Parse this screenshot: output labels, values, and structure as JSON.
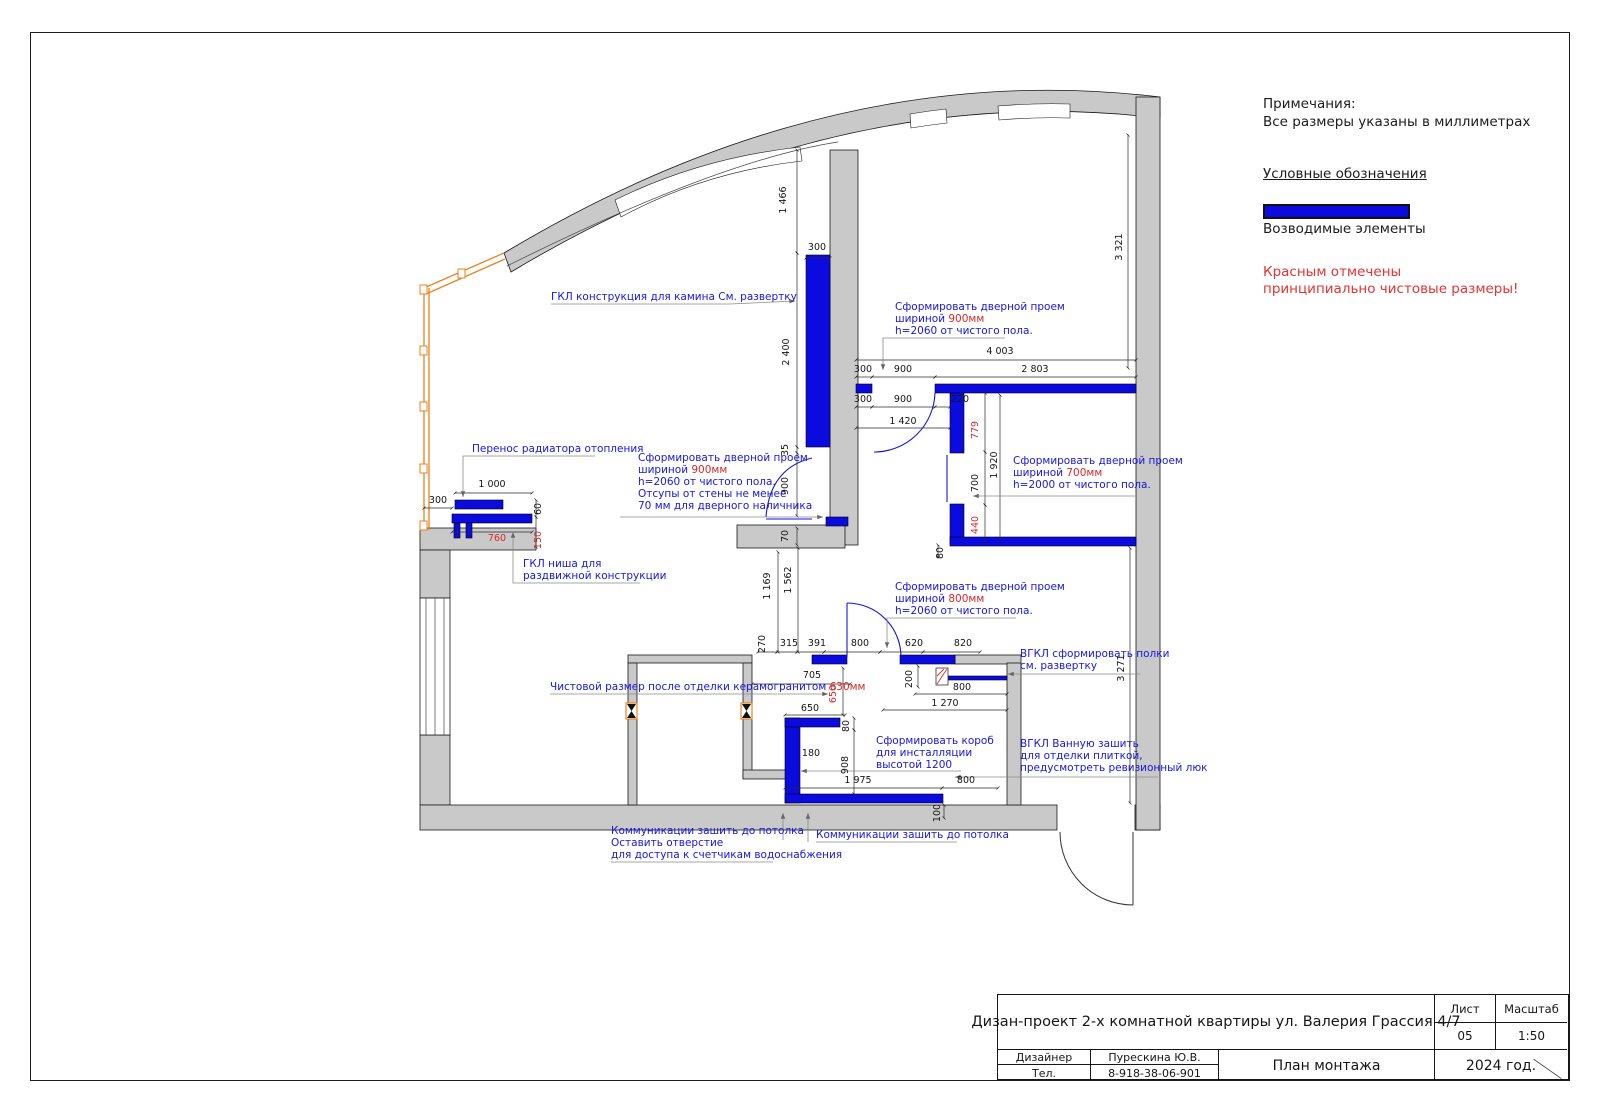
{
  "notes": {
    "title": "Примечания:",
    "subtitle": "Все размеры указаны в миллиметрах",
    "legend_title": "Условные обозначения",
    "legend_item": "Возводимые элементы",
    "red_note_line1": "Красным отмечены",
    "red_note_line2": "принципиально чистовые размеры!",
    "accent_blue": "#0b0bdf",
    "accent_red": "#d42a2a",
    "wall_gray": "#c9c9c9",
    "glazing_orange": "#e8821e"
  },
  "title_block": {
    "project": "Дизан-проект 2-х комнатной квартиры ул. Валерия Грассия 4/7",
    "sheet_label": "Лист",
    "sheet_value": "05",
    "scale_label": "Масштаб",
    "scale_value": "1:50",
    "designer_label": "Дизайнер",
    "designer_value": "Пурескина Ю.В.",
    "phone_label": "Тел.",
    "phone_value": "8-918-38-06-901",
    "drawing_title": "План монтажа",
    "year": "2024 год."
  },
  "plan": {
    "annotations": [
      {
        "x": 551,
        "y": 300,
        "lines": [
          [
            {
              "t": "ГКЛ конструкция для камина См. развертку"
            }
          ]
        ]
      },
      {
        "x": 472,
        "y": 452,
        "lines": [
          [
            {
              "t": "Перенос радиатора отопления"
            }
          ]
        ]
      },
      {
        "x": 638,
        "y": 461,
        "lines": [
          [
            {
              "t": "Сформировать дверной проем"
            }
          ],
          [
            {
              "t": "шириной "
            },
            {
              "t": "900мм",
              "c": "r"
            }
          ],
          [
            {
              "t": "h=2060 от чистого пола."
            }
          ],
          [
            {
              "t": "Отсупы от стены не менее"
            }
          ],
          [
            {
              "t": "70 мм для дверного наличника"
            }
          ]
        ]
      },
      {
        "x": 523,
        "y": 567,
        "lines": [
          [
            {
              "t": "ГКЛ ниша для"
            }
          ],
          [
            {
              "t": "раздвижной конструкции"
            }
          ]
        ]
      },
      {
        "x": 895,
        "y": 310,
        "lines": [
          [
            {
              "t": "Сформировать дверной проем"
            }
          ],
          [
            {
              "t": "шириной "
            },
            {
              "t": "900мм",
              "c": "r"
            }
          ],
          [
            {
              "t": "h=2060 от чистого пола."
            }
          ]
        ]
      },
      {
        "x": 1013,
        "y": 464,
        "lines": [
          [
            {
              "t": "Сформировать дверной проем"
            }
          ],
          [
            {
              "t": "шириной "
            },
            {
              "t": "700мм",
              "c": "r"
            }
          ],
          [
            {
              "t": "h=2000 от чистого пола."
            }
          ]
        ]
      },
      {
        "x": 895,
        "y": 590,
        "lines": [
          [
            {
              "t": "Сформировать дверной проем"
            }
          ],
          [
            {
              "t": "шириной "
            },
            {
              "t": "800мм",
              "c": "r"
            }
          ],
          [
            {
              "t": "h=2060 от чистого пола."
            }
          ]
        ]
      },
      {
        "x": 1020,
        "y": 657,
        "lines": [
          [
            {
              "t": "ВГКЛ сформировать полки"
            }
          ],
          [
            {
              "t": "см. развертку"
            }
          ]
        ]
      },
      {
        "x": 1020,
        "y": 747,
        "lines": [
          [
            {
              "t": "ВГКЛ Ванную зашить"
            }
          ],
          [
            {
              "t": "для отделки плиткой,"
            }
          ],
          [
            {
              "t": "предусмотреть ревизионный люк"
            }
          ]
        ]
      },
      {
        "x": 550,
        "y": 690,
        "lines": [
          [
            {
              "t": "Чистовой размер после отделки керамогранитом "
            },
            {
              "t": "630мм",
              "c": "r"
            }
          ]
        ]
      },
      {
        "x": 876,
        "y": 744,
        "lines": [
          [
            {
              "t": "Сформировать короб"
            }
          ],
          [
            {
              "t": "для инсталляции"
            }
          ],
          [
            {
              "t": "высотой 1200"
            }
          ]
        ]
      },
      {
        "x": 611,
        "y": 834,
        "lines": [
          [
            {
              "t": "Коммуникации зашить до потолка"
            }
          ],
          [
            {
              "t": "Оставить отверстие"
            }
          ],
          [
            {
              "t": "для доступа к счетчикам водоснабжения"
            }
          ]
        ]
      },
      {
        "x": 816,
        "y": 838,
        "lines": [
          [
            {
              "t": "Коммуникации зашить до потолка"
            }
          ]
        ]
      }
    ],
    "dim_labels": [
      {
        "t": "1 466",
        "x": 786,
        "y": 200,
        "r": 1
      },
      {
        "t": "300",
        "x": 817,
        "y": 250
      },
      {
        "t": "2 400",
        "x": 789,
        "y": 352,
        "r": 1
      },
      {
        "t": "35",
        "x": 788,
        "y": 450,
        "r": 1
      },
      {
        "t": "900",
        "x": 788,
        "y": 486,
        "r": 1
      },
      {
        "t": "70",
        "x": 788,
        "y": 536,
        "r": 1
      },
      {
        "t": "4 003",
        "x": 1000,
        "y": 354
      },
      {
        "t": "300",
        "x": 863,
        "y": 372
      },
      {
        "t": "900",
        "x": 903,
        "y": 372
      },
      {
        "t": "2 803",
        "x": 1035,
        "y": 372
      },
      {
        "t": "300",
        "x": 863,
        "y": 402
      },
      {
        "t": "900",
        "x": 903,
        "y": 402
      },
      {
        "t": "220",
        "x": 960,
        "y": 402
      },
      {
        "t": "1 420",
        "x": 903,
        "y": 424
      },
      {
        "t": "3 321",
        "x": 1122,
        "y": 247,
        "r": 1
      },
      {
        "t": "779",
        "x": 978,
        "y": 430,
        "r": 1,
        "c": "r"
      },
      {
        "t": "700",
        "x": 978,
        "y": 483,
        "r": 1
      },
      {
        "t": "1 920",
        "x": 997,
        "y": 465,
        "r": 1
      },
      {
        "t": "440",
        "x": 978,
        "y": 525,
        "r": 1,
        "c": "r"
      },
      {
        "t": "80",
        "x": 943,
        "y": 553,
        "r": 1
      },
      {
        "t": "3 271",
        "x": 1124,
        "y": 668,
        "r": 1
      },
      {
        "t": "1 000",
        "x": 492,
        "y": 487
      },
      {
        "t": "300",
        "x": 438,
        "y": 503
      },
      {
        "t": "60",
        "x": 541,
        "y": 509,
        "r": 1
      },
      {
        "t": "760",
        "x": 497,
        "y": 541,
        "c": "r"
      },
      {
        "t": "150",
        "x": 541,
        "y": 540,
        "r": 1,
        "c": "r"
      },
      {
        "t": "1 169",
        "x": 770,
        "y": 586,
        "r": 1
      },
      {
        "t": "1 562",
        "x": 791,
        "y": 580,
        "r": 1
      },
      {
        "t": "270",
        "x": 765,
        "y": 644,
        "r": 1
      },
      {
        "t": "315",
        "x": 789,
        "y": 646
      },
      {
        "t": "391",
        "x": 817,
        "y": 646
      },
      {
        "t": "800",
        "x": 860,
        "y": 646
      },
      {
        "t": "620",
        "x": 914,
        "y": 646
      },
      {
        "t": "820",
        "x": 963,
        "y": 646
      },
      {
        "t": "705",
        "x": 812,
        "y": 678
      },
      {
        "t": "650",
        "x": 836,
        "y": 694,
        "r": 1,
        "c": "r"
      },
      {
        "t": "650",
        "x": 810,
        "y": 711
      },
      {
        "t": "80",
        "x": 849,
        "y": 726,
        "r": 1
      },
      {
        "t": "180",
        "x": 811,
        "y": 756
      },
      {
        "t": "908",
        "x": 848,
        "y": 765,
        "r": 1
      },
      {
        "t": "1 975",
        "x": 858,
        "y": 783
      },
      {
        "t": "800",
        "x": 966,
        "y": 783
      },
      {
        "t": "100",
        "x": 940,
        "y": 813,
        "r": 1
      },
      {
        "t": "200",
        "x": 912,
        "y": 679,
        "r": 1
      },
      {
        "t": "800",
        "x": 962,
        "y": 690
      },
      {
        "t": "1 270",
        "x": 945,
        "y": 706
      }
    ]
  }
}
